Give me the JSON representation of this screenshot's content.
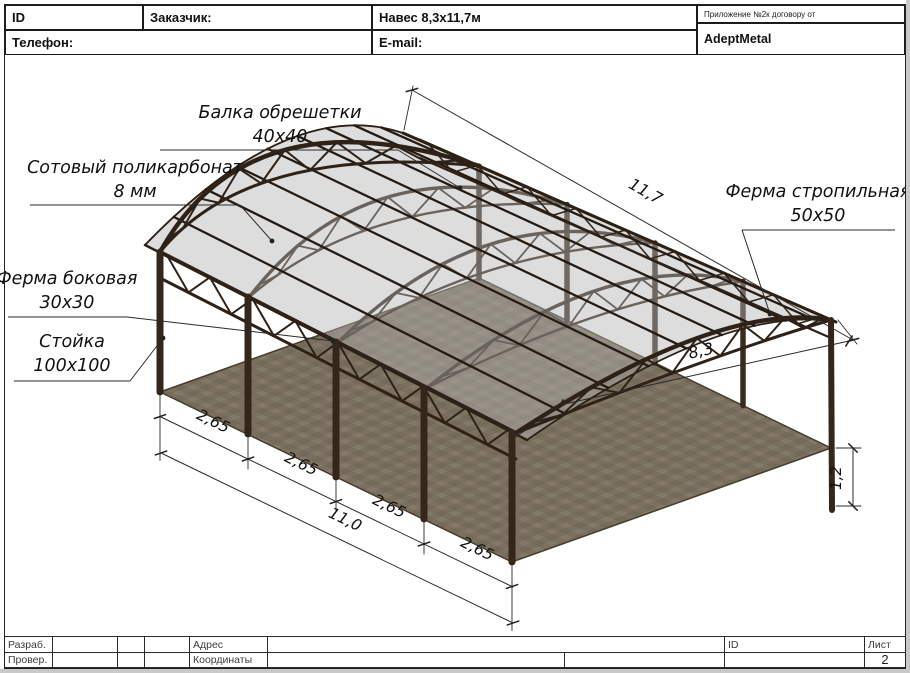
{
  "header": {
    "id_label": "ID",
    "customer_label": "Заказчик:",
    "doc_title": "Навес 8,3x11,7м",
    "phone_label": "Телефон:",
    "email_label": "E-mail:",
    "appendix_note": "Приложение №2к договору от",
    "company_name": "AdeptMetal"
  },
  "callouts": [
    {
      "line1": "Балка обрешетки",
      "line2": "40x40"
    },
    {
      "line1": "Сотовый поликарбонат",
      "line2": "8 мм"
    },
    {
      "line1": "Ферма боковая",
      "line2": "30x30"
    },
    {
      "line1": "Стойка",
      "line2": "100x100"
    },
    {
      "line1": "Ферма стропильная",
      "line2": "50x50"
    }
  ],
  "dimensions": {
    "roof_length": "11,7",
    "width": "8,3",
    "bay_spacings": [
      "2,65",
      "2,65",
      "2,65",
      "2,65"
    ],
    "total_length": "11,0",
    "embed_depth": "1,2"
  },
  "footer": {
    "developed_label": "Разраб.",
    "checked_label": "Провер.",
    "address_label": "Адрес",
    "coordinates_label": "Координаты",
    "id_label": "ID",
    "sheet_label": "Лист",
    "sheet_number": "2"
  },
  "colors": {
    "metal": "#2e2117",
    "post": "#35261b",
    "sheet": "#b3b3b3",
    "sheet_edge": "#2c2015",
    "ground": "#7b7060",
    "ground_dark": "#6b6252",
    "ground_light": "#847968",
    "line": "#2a2a2a",
    "text": "#111111"
  }
}
